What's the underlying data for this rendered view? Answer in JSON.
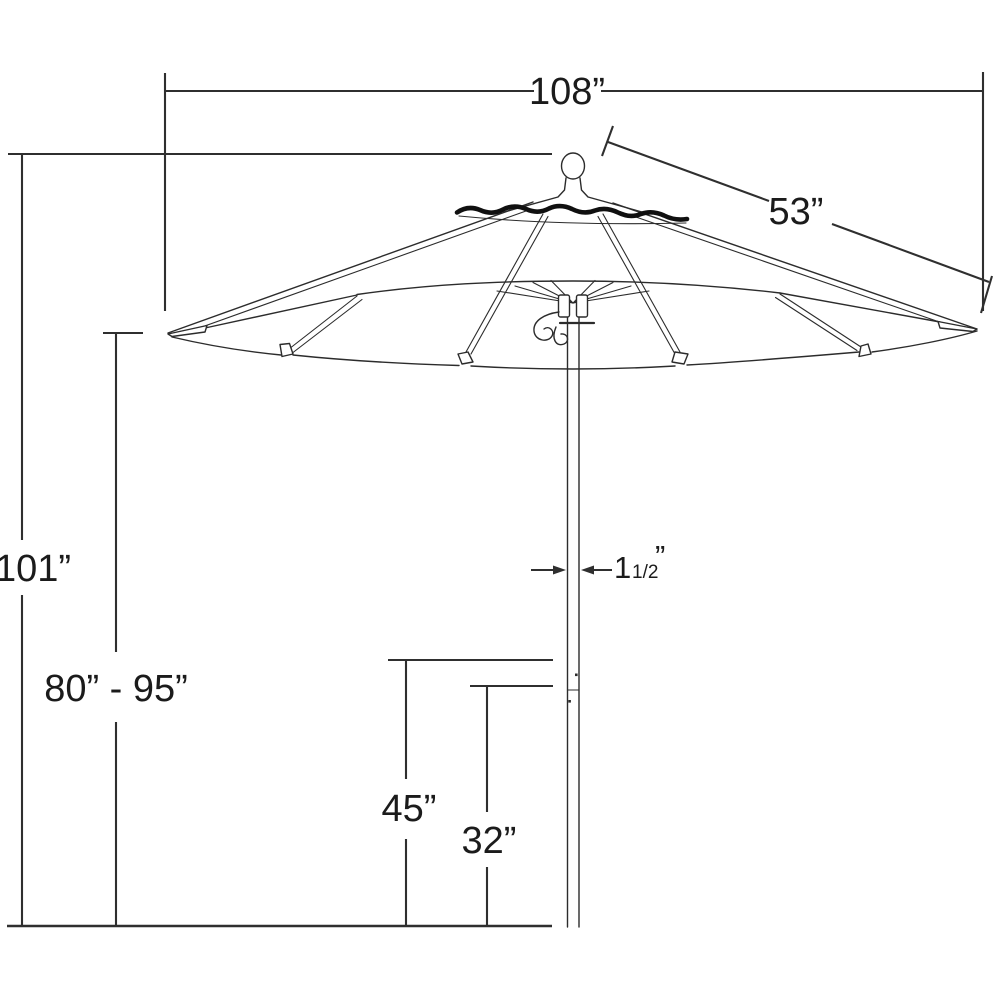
{
  "colors": {
    "background": "#ffffff",
    "line": "#2c2c2c",
    "dimension_line": "#2f2f2f",
    "text": "#1b1b1b",
    "vent_band": "#101010"
  },
  "labels": {
    "canopy_width": "108”",
    "rib_length": "53”",
    "total_height": "101”",
    "height_range": "80” - 95”",
    "lower_clearance": "45”",
    "table_clearance": "32”",
    "pole_diameter_whole": "1",
    "pole_diameter_fraction": "1/2",
    "pole_diameter_unit": "”"
  }
}
